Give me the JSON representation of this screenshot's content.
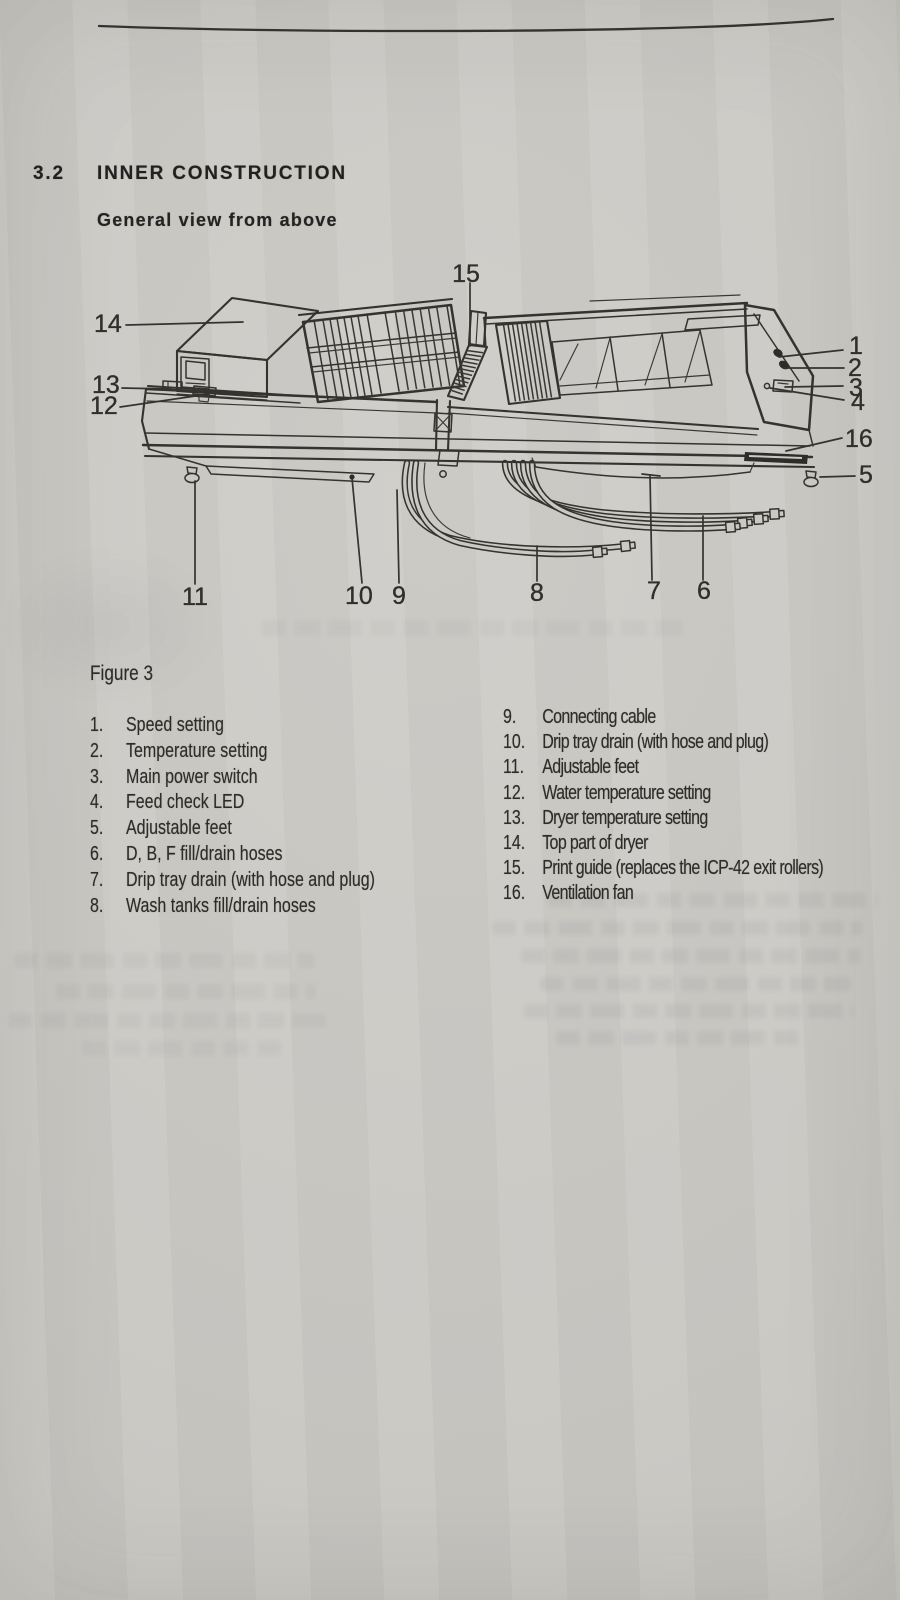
{
  "header": {
    "section_number": "3.2",
    "section_title": "INNER CONSTRUCTION",
    "subtitle": "General view from above"
  },
  "figure": {
    "caption": "Figure 3",
    "callouts": [
      "1",
      "2",
      "3",
      "4",
      "5",
      "6",
      "7",
      "8",
      "9",
      "10",
      "11",
      "12",
      "13",
      "14",
      "15",
      "16"
    ]
  },
  "legend": {
    "left": [
      {
        "n": "1.",
        "t": "Speed setting"
      },
      {
        "n": "2.",
        "t": "Temperature setting"
      },
      {
        "n": "3.",
        "t": "Main power switch"
      },
      {
        "n": "4.",
        "t": "Feed check LED"
      },
      {
        "n": "5.",
        "t": "Adjustable feet"
      },
      {
        "n": "6.",
        "t": "D, B, F fill/drain hoses"
      },
      {
        "n": "7.",
        "t": "Drip tray drain (with hose and plug)"
      },
      {
        "n": "8.",
        "t": "Wash tanks fill/drain hoses"
      }
    ],
    "right": [
      {
        "n": "9.",
        "t": "Connecting cable"
      },
      {
        "n": "10.",
        "t": "Drip tray drain (with hose and plug)"
      },
      {
        "n": "11.",
        "t": "Adjustable feet"
      },
      {
        "n": "12.",
        "t": "Water temperature setting"
      },
      {
        "n": "13.",
        "t": "Dryer temperature setting"
      },
      {
        "n": "14.",
        "t": "Top part of dryer"
      },
      {
        "n": "15.",
        "t": "Print guide (replaces the ICP-42 exit rollers)"
      },
      {
        "n": "16.",
        "t": "Ventilation fan"
      }
    ]
  },
  "colors": {
    "paper": "#cac8c3",
    "ink": "#2d2c29",
    "line": "#35332f"
  }
}
